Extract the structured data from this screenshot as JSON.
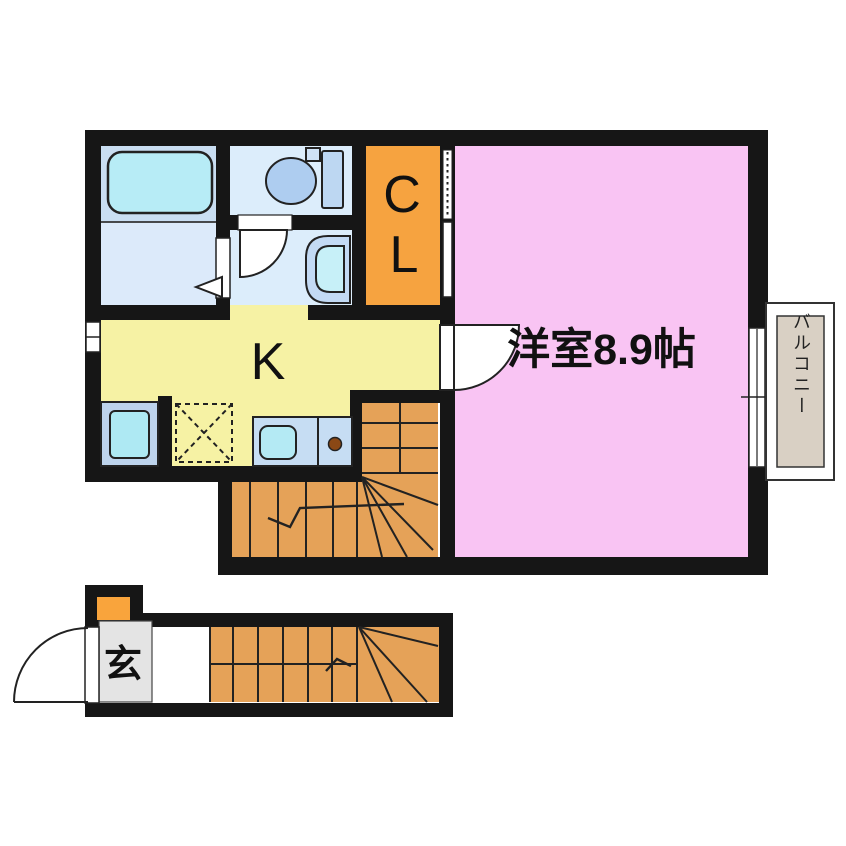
{
  "plan": {
    "rooms": {
      "western_room": {
        "label": "洋室8.9帖"
      },
      "kitchen": {
        "label": "K"
      },
      "closet": {
        "letter_top": "C",
        "letter_bottom": "L"
      },
      "balcony": {
        "label": "バルコニー"
      },
      "entrance": {
        "label": "玄"
      }
    },
    "colors": {
      "wall": "#161616",
      "western_room": "#f9c4f3",
      "kitchen": "#f6f2a4",
      "stairs": "#e5a258",
      "closet": "#f6a340",
      "shoe_cabinet": "#f9a43c",
      "bathroom": "#c9def2",
      "washroom": "#dceafa",
      "toilet_room": "#dcedfb",
      "bathtub": "#b7ecf6",
      "toilet_bowl": "#aecdf0",
      "toilet_tank": "#bdd7f2",
      "toilet_flush": "#cfe2f6",
      "washbasin_body": "#c3daf4",
      "washbasin_bowl": "#c7f0f8",
      "washer_body": "#bdd3ec",
      "washer_drum": "#aee9f3",
      "counter": "#c6ddf3",
      "counter_sink": "#b4eaf4",
      "burner": "#8a4815",
      "balcony_deck": "#d9d0c4",
      "genkan_floor": "#e4e4e4",
      "paper": "#ffffff"
    },
    "fixtures": [
      "bathtub",
      "toilet",
      "washbasin",
      "washing-machine",
      "refrigerator-space",
      "kitchen-sink",
      "gas-burner",
      "staircase-upper",
      "staircase-lower",
      "entrance-door",
      "balcony-sliding-door",
      "window"
    ]
  }
}
